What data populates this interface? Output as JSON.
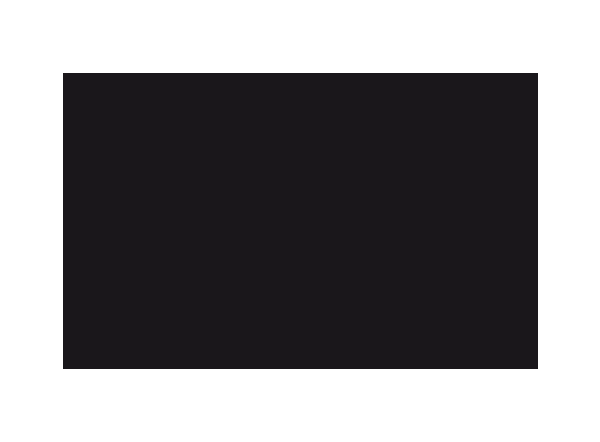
{
  "colors": {
    "page_background": "#ffffff",
    "screen_fill": "#1a171b"
  },
  "screen": {
    "content_text": ""
  }
}
